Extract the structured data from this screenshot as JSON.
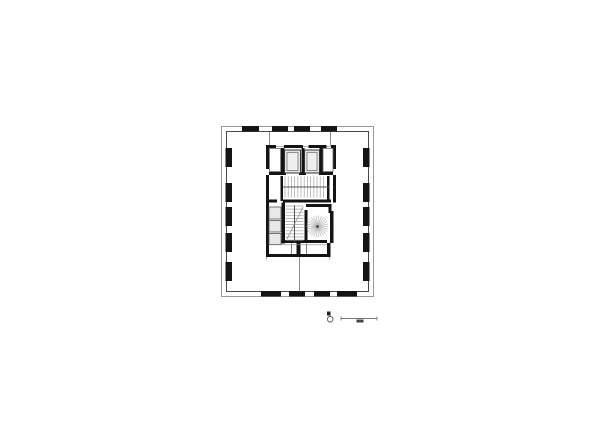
{
  "sheet": {
    "kind": "architectural-floor-plan",
    "background": "#ffffff",
    "ink": "#141414",
    "light_line": "#9a9a9a",
    "mid_line": "#4a4a4a",
    "shaft_fill": "#e3e3e3",
    "cell_fill": "#e8e8e8"
  },
  "plan": {
    "groups": [
      {
        "name": "perimeter",
        "shapes": [
          {
            "t": "rect",
            "n": "facade-outer-line",
            "x": 221.5,
            "y": 126.5,
            "w": 152,
            "h": 170,
            "s": "#9a9a9a",
            "sw": 1
          },
          {
            "t": "rect",
            "n": "facade-inner-line",
            "x": 226.5,
            "y": 131.5,
            "w": 142,
            "h": 160,
            "s": "#4a4a4a",
            "sw": 1
          }
        ]
      },
      {
        "name": "facade-columns",
        "shapes": [
          {
            "t": "rect",
            "n": "column-top",
            "x": 242,
            "y": 126,
            "w": 17,
            "h": 5.5,
            "f": "#141414"
          },
          {
            "t": "rect",
            "n": "column-top",
            "x": 272,
            "y": 126,
            "w": 16,
            "h": 5.5,
            "f": "#141414"
          },
          {
            "t": "rect",
            "n": "column-top",
            "x": 294,
            "y": 126,
            "w": 16,
            "h": 5.5,
            "f": "#141414"
          },
          {
            "t": "rect",
            "n": "column-top",
            "x": 321,
            "y": 126,
            "w": 16,
            "h": 5.5,
            "f": "#141414"
          },
          {
            "t": "rect",
            "n": "column-bottom",
            "x": 261,
            "y": 291,
            "w": 20,
            "h": 5.5,
            "f": "#141414"
          },
          {
            "t": "rect",
            "n": "column-bottom",
            "x": 289,
            "y": 291,
            "w": 16,
            "h": 5.5,
            "f": "#141414"
          },
          {
            "t": "rect",
            "n": "column-bottom",
            "x": 314,
            "y": 291,
            "w": 16,
            "h": 5.5,
            "f": "#141414"
          },
          {
            "t": "rect",
            "n": "column-bottom",
            "x": 337,
            "y": 291,
            "w": 20,
            "h": 5.5,
            "f": "#141414"
          },
          {
            "t": "rect",
            "n": "column-left",
            "x": 225.5,
            "y": 148,
            "w": 6.5,
            "h": 19,
            "f": "#141414"
          },
          {
            "t": "rect",
            "n": "column-left",
            "x": 225.5,
            "y": 183,
            "w": 6.5,
            "h": 19,
            "f": "#141414"
          },
          {
            "t": "rect",
            "n": "column-left",
            "x": 225.5,
            "y": 207,
            "w": 6.5,
            "h": 19,
            "f": "#141414"
          },
          {
            "t": "rect",
            "n": "column-left",
            "x": 225.5,
            "y": 233,
            "w": 6.5,
            "h": 19,
            "f": "#141414"
          },
          {
            "t": "rect",
            "n": "column-left",
            "x": 225.5,
            "y": 262,
            "w": 6.5,
            "h": 19,
            "f": "#141414"
          },
          {
            "t": "rect",
            "n": "column-right",
            "x": 363,
            "y": 148,
            "w": 6.5,
            "h": 19,
            "f": "#141414"
          },
          {
            "t": "rect",
            "n": "column-right",
            "x": 363,
            "y": 183,
            "w": 6.5,
            "h": 19,
            "f": "#141414"
          },
          {
            "t": "rect",
            "n": "column-right",
            "x": 363,
            "y": 207,
            "w": 6.5,
            "h": 19,
            "f": "#141414"
          },
          {
            "t": "rect",
            "n": "column-right",
            "x": 363,
            "y": 233,
            "w": 6.5,
            "h": 19,
            "f": "#141414"
          },
          {
            "t": "rect",
            "n": "column-right",
            "x": 363,
            "y": 262,
            "w": 6.5,
            "h": 19,
            "f": "#141414"
          }
        ]
      },
      {
        "name": "partition-walls",
        "shapes": [
          {
            "t": "line",
            "n": "partition-north-west",
            "x1": 269.5,
            "y1": 132,
            "x2": 269.5,
            "y2": 145.5,
            "s": "#8a8a8a",
            "sw": 1
          },
          {
            "t": "line",
            "n": "partition-north-east",
            "x1": 330.5,
            "y1": 132,
            "x2": 330.5,
            "y2": 145.5,
            "s": "#8a8a8a",
            "sw": 1
          },
          {
            "t": "line",
            "n": "partition-south-center",
            "x1": 299.5,
            "y1": 257,
            "x2": 299.5,
            "y2": 291.5,
            "s": "#8a8a8a",
            "sw": 1
          }
        ]
      },
      {
        "name": "core-walls",
        "shapes": [
          {
            "t": "line",
            "n": "core-top-thin-line",
            "x1": 266,
            "y1": 146.5,
            "x2": 336,
            "y2": 146.5,
            "s": "#999999",
            "sw": 0.8
          },
          {
            "t": "rect",
            "n": "core-top-wall",
            "x": 266,
            "y": 145,
            "w": 10,
            "h": 3,
            "f": "#141414"
          },
          {
            "t": "rect",
            "n": "core-top-wall",
            "x": 284,
            "y": 145,
            "w": 19,
            "h": 3,
            "f": "#141414"
          },
          {
            "t": "rect",
            "n": "core-top-wall",
            "x": 308.5,
            "y": 145,
            "w": 18,
            "h": 3,
            "f": "#141414"
          },
          {
            "t": "rect",
            "n": "core-top-wall",
            "x": 331,
            "y": 145,
            "w": 5,
            "h": 3,
            "f": "#141414"
          },
          {
            "t": "rect",
            "n": "core-west-wall",
            "x": 266,
            "y": 145,
            "w": 3,
            "h": 24,
            "f": "#141414"
          },
          {
            "t": "rect",
            "n": "core-west-wall",
            "x": 266,
            "y": 175,
            "w": 3,
            "h": 27.5,
            "f": "#141414"
          },
          {
            "t": "rect",
            "n": "core-east-wall",
            "x": 333,
            "y": 145,
            "w": 3,
            "h": 24,
            "f": "#141414"
          },
          {
            "t": "rect",
            "n": "core-east-wall",
            "x": 333,
            "y": 175,
            "w": 3,
            "h": 27.5,
            "f": "#141414"
          },
          {
            "t": "rect",
            "n": "elevator-shaft-wall",
            "x": 281,
            "y": 148,
            "w": 3.5,
            "h": 26,
            "f": "#141414"
          },
          {
            "t": "rect",
            "n": "elevator-shaft-wall",
            "x": 301.5,
            "y": 148,
            "w": 3,
            "h": 26,
            "f": "#141414"
          },
          {
            "t": "rect",
            "n": "elevator-shaft-wall",
            "x": 319.5,
            "y": 148,
            "w": 3.5,
            "h": 26,
            "f": "#141414"
          },
          {
            "t": "rect",
            "n": "elevator-lobby-wall",
            "x": 269,
            "y": 172,
            "w": 17,
            "h": 3,
            "f": "#141414"
          },
          {
            "t": "rect",
            "n": "elevator-lobby-wall",
            "x": 299,
            "y": 172,
            "w": 7,
            "h": 3,
            "f": "#141414"
          },
          {
            "t": "rect",
            "n": "elevator-lobby-wall",
            "x": 319,
            "y": 172,
            "w": 14,
            "h": 3,
            "f": "#141414"
          },
          {
            "t": "rect",
            "n": "stairwell-wall",
            "x": 280.5,
            "y": 176,
            "w": 2.5,
            "h": 25,
            "f": "#141414"
          },
          {
            "t": "rect",
            "n": "stairwell-wall",
            "x": 327,
            "y": 176,
            "w": 2.5,
            "h": 25,
            "f": "#141414"
          },
          {
            "t": "rect",
            "n": "core-mid-wall",
            "x": 266,
            "y": 199.5,
            "w": 11,
            "h": 3,
            "f": "#141414"
          },
          {
            "t": "rect",
            "n": "core-mid-wall",
            "x": 283,
            "y": 199.5,
            "w": 48,
            "h": 3,
            "f": "#141414"
          },
          {
            "t": "rect",
            "n": "core-mid-wall",
            "x": 333.5,
            "y": 199.5,
            "w": 2.5,
            "h": 3,
            "f": "#141414"
          },
          {
            "t": "rect",
            "n": "core-west-wall-lower",
            "x": 266,
            "y": 202.5,
            "w": 3,
            "h": 41,
            "f": "#141414"
          },
          {
            "t": "rect",
            "n": "shaft-cells-wall",
            "x": 281.5,
            "y": 202.5,
            "w": 3.5,
            "h": 41,
            "f": "#141414"
          },
          {
            "t": "rect",
            "n": "spiral-room-wall-top",
            "x": 306,
            "y": 204,
            "w": 25.5,
            "h": 3,
            "f": "#141414"
          },
          {
            "t": "rect",
            "n": "spiral-room-wall-hook",
            "x": 328.5,
            "y": 204,
            "w": 3,
            "h": 9,
            "f": "#141414"
          },
          {
            "t": "rect",
            "n": "spiral-room-wall-west",
            "x": 304.5,
            "y": 210,
            "w": 3,
            "h": 33,
            "f": "#141414"
          },
          {
            "t": "rect",
            "n": "spiral-room-wall-east",
            "x": 330,
            "y": 211,
            "w": 3.5,
            "h": 32,
            "f": "#141414"
          },
          {
            "t": "rect",
            "n": "service-band-wall-top",
            "x": 268,
            "y": 240,
            "w": 59,
            "h": 3,
            "f": "#141414"
          },
          {
            "t": "rect",
            "n": "service-band-cap-west",
            "x": 266,
            "y": 243,
            "w": 3,
            "h": 14,
            "f": "#141414"
          },
          {
            "t": "rect",
            "n": "service-band-cap-east",
            "x": 327,
            "y": 243,
            "w": 3.5,
            "h": 14,
            "f": "#141414"
          },
          {
            "t": "rect",
            "n": "service-band-wall-bottom",
            "x": 266,
            "y": 254,
            "w": 64,
            "h": 3,
            "f": "#141414"
          },
          {
            "t": "rect",
            "n": "service-band-door-post",
            "x": 296.5,
            "y": 243,
            "w": 4,
            "h": 11,
            "f": "#141414"
          }
        ]
      },
      {
        "name": "core-rooms",
        "shapes": [
          {
            "t": "rect",
            "n": "side-slot-west",
            "x": 269.5,
            "y": 148.5,
            "w": 11,
            "h": 23,
            "s": "#666666",
            "sw": 0.8,
            "f": "#ffffff"
          },
          {
            "t": "rect",
            "n": "side-slot-east",
            "x": 323,
            "y": 148.5,
            "w": 10,
            "h": 23,
            "s": "#666666",
            "sw": 0.8,
            "f": "#ffffff"
          },
          {
            "t": "rect",
            "n": "elevator-shaft-a",
            "x": 284.5,
            "y": 150,
            "w": 16,
            "h": 23,
            "s": "#333333",
            "sw": 1,
            "f": "#e3e3e3"
          },
          {
            "t": "rect",
            "n": "elevator-shaft-b",
            "x": 304.5,
            "y": 150,
            "w": 15,
            "h": 23,
            "s": "#333333",
            "sw": 1,
            "f": "#e3e3e3"
          },
          {
            "t": "rect",
            "n": "elevator-car-a",
            "x": 287,
            "y": 152.5,
            "w": 11,
            "h": 18,
            "s": "#777777",
            "sw": 0.8,
            "f": "#efefef"
          },
          {
            "t": "rect",
            "n": "elevator-car-b",
            "x": 307,
            "y": 152.5,
            "w": 10,
            "h": 18,
            "s": "#777777",
            "sw": 0.8,
            "f": "#efefef"
          },
          {
            "t": "rect",
            "n": "shaft-cell",
            "x": 269,
            "y": 207,
            "w": 12,
            "h": 12,
            "s": "#555555",
            "sw": 0.8,
            "f": "#e8e8e8"
          },
          {
            "t": "rect",
            "n": "shaft-cell",
            "x": 269,
            "y": 220.5,
            "w": 12,
            "h": 11.5,
            "s": "#555555",
            "sw": 0.8,
            "f": "#e8e8e8"
          },
          {
            "t": "rect",
            "n": "shaft-cell",
            "x": 269,
            "y": 233.5,
            "w": 12,
            "h": 11,
            "s": "#555555",
            "sw": 0.8,
            "f": "#e8e8e8"
          }
        ]
      },
      {
        "name": "core-stairs",
        "shapes": [
          {
            "t": "treads",
            "n": "straight-stair-treads",
            "dir": "v",
            "from": 285,
            "to": 326,
            "step": 3.2,
            "a": 176.5,
            "b": 197.5,
            "s": "#a0a0a0",
            "sw": 0.7
          },
          {
            "t": "line",
            "n": "straight-stair-landing",
            "x1": 283,
            "y1": 187,
            "x2": 329,
            "y2": 187,
            "s": "#555555",
            "sw": 1
          },
          {
            "t": "treads",
            "n": "dogleg-stair-treads",
            "dir": "h",
            "from": 206,
            "to": 241,
            "step": 3.1,
            "a": 285.5,
            "b": 303.5,
            "s": "#a0a0a0",
            "sw": 0.7
          },
          {
            "t": "line",
            "n": "dogleg-stair-newel",
            "x1": 294.5,
            "y1": 205.5,
            "x2": 294.5,
            "y2": 242,
            "s": "#555555",
            "sw": 1
          },
          {
            "t": "line",
            "n": "dogleg-stair-break-line",
            "x1": 287,
            "y1": 239,
            "x2": 303,
            "y2": 207,
            "s": "#8a8a8a",
            "sw": 0.8
          },
          {
            "t": "line",
            "n": "service-band-divider",
            "x1": 291.5,
            "y1": 243.5,
            "x2": 291.5,
            "y2": 254,
            "s": "#666666",
            "sw": 0.8
          },
          {
            "t": "line",
            "n": "service-band-divider",
            "x1": 306.5,
            "y1": 243.5,
            "x2": 306.5,
            "y2": 254,
            "s": "#666666",
            "sw": 0.8
          },
          {
            "t": "line",
            "n": "service-band-inner-line",
            "x1": 269,
            "y1": 244.8,
            "x2": 327,
            "y2": 244.8,
            "s": "#888888",
            "sw": 0.6
          },
          {
            "t": "line",
            "n": "service-band-stub",
            "x1": 266.5,
            "y1": 257,
            "x2": 266.5,
            "y2": 259.5,
            "s": "#999999",
            "sw": 0.8
          },
          {
            "t": "line",
            "n": "service-band-stub",
            "x1": 329.5,
            "y1": 257,
            "x2": 329.5,
            "y2": 259.5,
            "s": "#999999",
            "sw": 0.8
          }
        ]
      },
      {
        "name": "spiral-stair",
        "shapes": [
          {
            "t": "rays",
            "n": "spiral-stair-treads",
            "cx": 317.5,
            "cy": 226.5,
            "r": 11,
            "count": 26,
            "s": "#b8b8b8",
            "sw": 0.7
          },
          {
            "t": "circle",
            "n": "spiral-stair-newel",
            "cx": 317.5,
            "cy": 226.5,
            "r": 1.3,
            "f": "#333333"
          }
        ]
      },
      {
        "name": "north-arrow",
        "shapes": [
          {
            "t": "rect",
            "n": "north-arrow-flag",
            "x": 327,
            "y": 311.5,
            "w": 3.5,
            "h": 4,
            "f": "#222222"
          },
          {
            "t": "line",
            "n": "north-arrow-stem",
            "x1": 330,
            "y1": 315.5,
            "x2": 330.2,
            "y2": 316.8,
            "s": "#555555",
            "sw": 0.8
          },
          {
            "t": "circle",
            "n": "north-arrow-ring",
            "cx": 330.2,
            "cy": 319.2,
            "r": 2.8,
            "s": "#555555",
            "sw": 0.9
          }
        ]
      },
      {
        "name": "scale-bar",
        "shapes": [
          {
            "t": "line",
            "n": "scale-bar-line",
            "x1": 341,
            "y1": 318.5,
            "x2": 377,
            "y2": 318.5,
            "s": "#777777",
            "sw": 0.9
          },
          {
            "t": "line",
            "n": "scale-bar-tick",
            "x1": 341,
            "y1": 316.5,
            "x2": 341,
            "y2": 320.5,
            "s": "#777777",
            "sw": 0.9
          },
          {
            "t": "line",
            "n": "scale-bar-tick",
            "x1": 377,
            "y1": 316.5,
            "x2": 377,
            "y2": 320.5,
            "s": "#777777",
            "sw": 0.9
          },
          {
            "t": "rect",
            "n": "scale-bar-label-mark",
            "x": 356.5,
            "y": 319.5,
            "w": 7,
            "h": 3,
            "f": "#454545"
          }
        ]
      }
    ]
  }
}
